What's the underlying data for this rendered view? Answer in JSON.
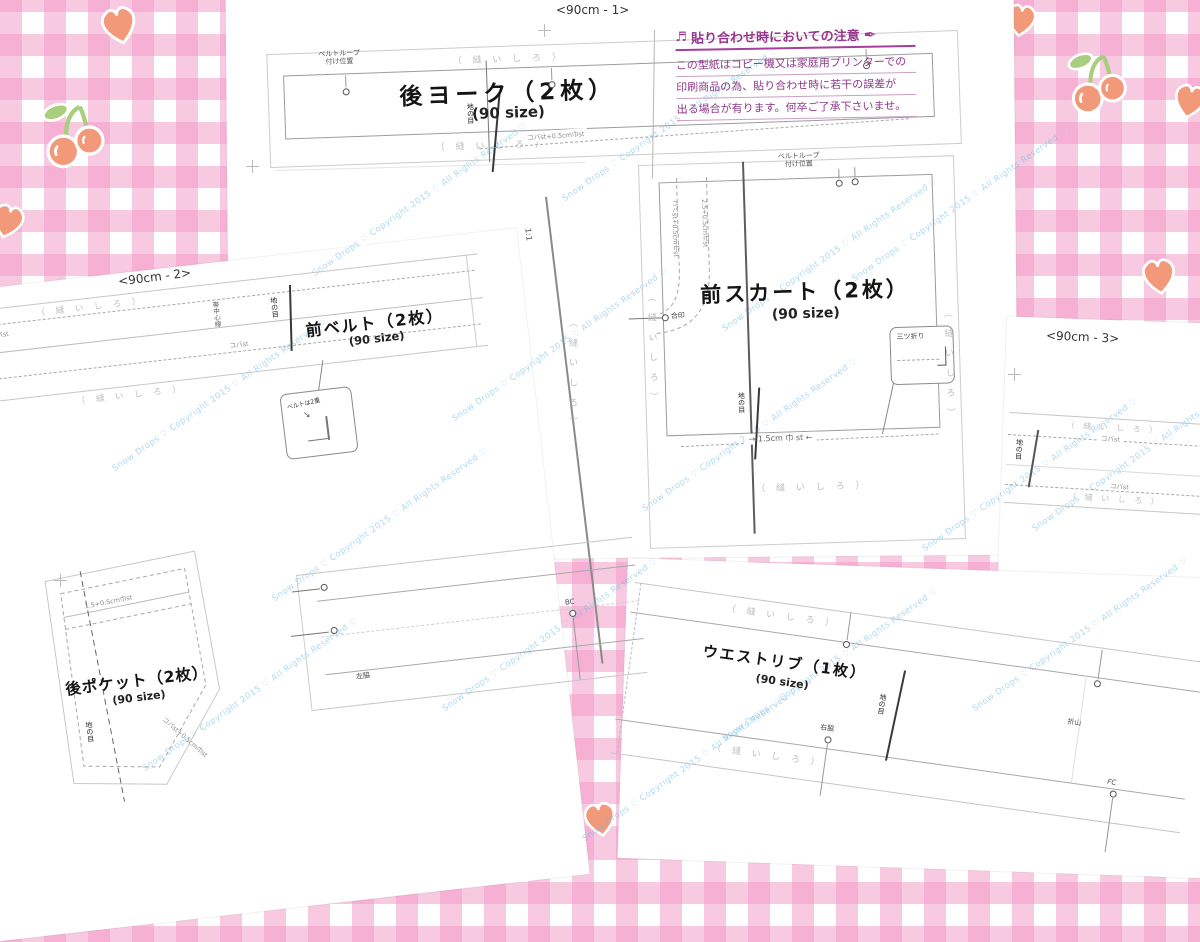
{
  "background": {
    "gingham_pink": "#F3A0C6",
    "motif_orange": "#F2997A",
    "leaf_green": "#A8CE7E",
    "paper_white": "#FFFFFF"
  },
  "page_labels": {
    "sheet1": "<90cm - 1>",
    "sheet2": "<90cm - 2>",
    "sheet3": "<90cm - 3>"
  },
  "watermark": {
    "text": "Snow Drops ♡ Copyright 2015 ♡ All Rights Reserved ♡",
    "color": "#79BEE4"
  },
  "icons": {
    "music": "♬",
    "pen": "✒",
    "arrow_right": "→",
    "arrow_left": "←"
  },
  "note": {
    "title": "貼り合わせ時においての注意",
    "color": "#96368E",
    "lines": [
      "この型紙はコピー機又は家庭用プリンターでの",
      "印刷商品の為、貼り合わせ時に若干の誤差が",
      "出る場合が有ります。何卒ご了承下さいませ。"
    ]
  },
  "shared": {
    "seam_allowance": "（ 縫 い し ろ ）",
    "size": "(90 size)",
    "grain": "地の目",
    "scale": "1:1"
  },
  "pieces": {
    "back_yoke": {
      "title": "後ヨーク（2枚）",
      "belt_loop_1": "ベルトループ",
      "belt_loop_2": "付け位置",
      "edge_stitch": "コバst+0.5cm巾st"
    },
    "front_skirt": {
      "title": "前スカート（2枚）",
      "belt_loop_1": "ベルトループ",
      "belt_loop_2": "付け位置",
      "pocket_stitch_1": "コバst+0.5cm巾st",
      "pocket_stitch_2": "2.5+0.5cm巾st",
      "notch": "合印",
      "triple_fold": "三ツ折り",
      "hem_stitch": "1.5cm 巾 st"
    },
    "front_belt": {
      "title": "前ベルト（2枚）",
      "edge_stitch": "コバst",
      "belt_center": "帯中心線",
      "callout": "ベルトは2重"
    },
    "back_pocket": {
      "title": "後ポケット（2枚）",
      "top_stitch": "1.5+0.5cm巾st",
      "edge_stitch": "コバst+0.5cm巾st"
    },
    "waist_rib": {
      "title": "ウエストリブ（1枚）",
      "right_side": "右脇",
      "fold_peak": "折山",
      "front_center": "FC"
    },
    "rib_left": {
      "left_side": "左脇",
      "back_center": "BC"
    },
    "belt_right": {
      "edge_stitch": "コバst"
    }
  }
}
